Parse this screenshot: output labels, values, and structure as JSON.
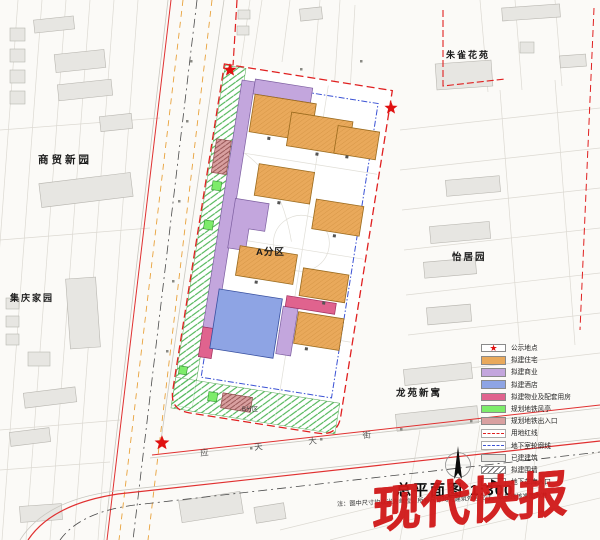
{
  "title": {
    "label": "总平面图",
    "scale": "1:300"
  },
  "note": "注：图中尺寸均以米为单位，所有尺寸均为建筑外包尺寸，以最终核准图为准",
  "watermark": "现代快报",
  "site": {
    "zone_label": "A分区",
    "zone_b_label": "B分区"
  },
  "map_labels": {
    "northwest_estate": "商贸新园",
    "west_estate": "集庆家园",
    "northeast_estate": "朱雀花苑",
    "east_estate": "怡居园",
    "southeast_estate": "龙苑新寓",
    "south_road": "应天大街"
  },
  "legend": {
    "items": [
      {
        "label": "公示地点",
        "type": "star",
        "glyph": "★",
        "color": "#e01010"
      },
      {
        "label": "拟建住宅",
        "type": "fill",
        "color": "#e9a95b"
      },
      {
        "label": "拟建商业",
        "type": "fill",
        "color": "#c3a6dd"
      },
      {
        "label": "拟建酒店",
        "type": "fill",
        "color": "#8ea4e4"
      },
      {
        "label": "拟建物业及配套用房",
        "type": "fill",
        "color": "#e0638e"
      },
      {
        "label": "规划地铁风亭",
        "type": "fill",
        "color": "#7dec6a"
      },
      {
        "label": "规划地铁出入口",
        "type": "fill",
        "color": "#d9a0a0"
      },
      {
        "label": "用地红线",
        "type": "red-dash",
        "color": "#e02020"
      },
      {
        "label": "地下室轮廓线",
        "type": "blue-dash",
        "color": "#3b52d4"
      },
      {
        "label": "已建建筑",
        "type": "fill",
        "color": "#e7e6e2"
      },
      {
        "label": "拟建围墙",
        "type": "hatch",
        "color": "#6b6b6b"
      },
      {
        "label": "地下车库入口",
        "type": "arrow",
        "color": "#111111"
      }
    ]
  }
}
